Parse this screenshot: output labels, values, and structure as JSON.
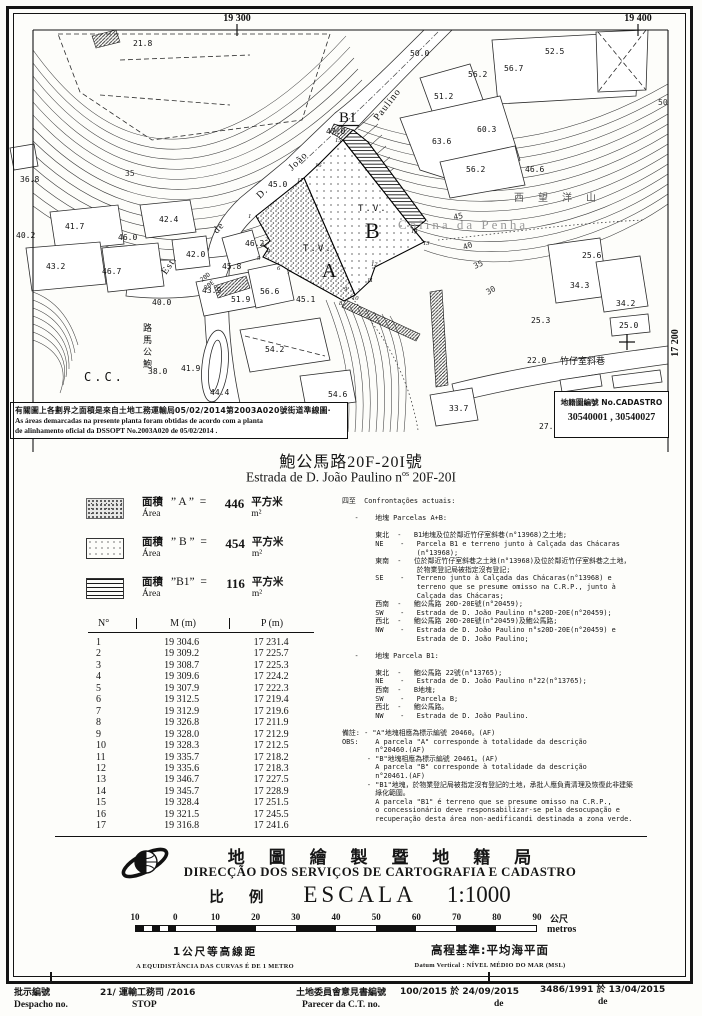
{
  "map": {
    "grid_labels": {
      "top_left": "19 300",
      "top_right": "19 400",
      "right": "17 200"
    },
    "labels": [
      {
        "t": "19 300",
        "x": 237,
        "y": 21,
        "s": 10,
        "c": "coord"
      },
      {
        "t": "19 400",
        "x": 638,
        "y": 21,
        "s": 10,
        "c": "coord"
      },
      {
        "t": "17 200",
        "x": 678,
        "y": 343,
        "s": 10,
        "r": -90,
        "c": "coord"
      },
      {
        "t": "21.8",
        "x": 133,
        "y": 46
      },
      {
        "t": "36.8",
        "x": 20,
        "y": 182
      },
      {
        "t": "35",
        "x": 125,
        "y": 176,
        "c": "contour"
      },
      {
        "t": "40.2",
        "x": 16,
        "y": 238
      },
      {
        "t": "41.7",
        "x": 65,
        "y": 229
      },
      {
        "t": "46.0",
        "x": 118,
        "y": 240
      },
      {
        "t": "43.2",
        "x": 46,
        "y": 269
      },
      {
        "t": "46.7",
        "x": 102,
        "y": 274
      },
      {
        "t": "42.4",
        "x": 159,
        "y": 222
      },
      {
        "t": "42.0",
        "x": 186,
        "y": 257
      },
      {
        "t": "40.0",
        "x": 152,
        "y": 305
      },
      {
        "t": "38.0",
        "x": 148,
        "y": 374
      },
      {
        "t": "41.9",
        "x": 181,
        "y": 371
      },
      {
        "t": "44.4",
        "x": 210,
        "y": 395
      },
      {
        "t": "C.C.",
        "x": 84,
        "y": 381,
        "s": 12,
        "c": "cc"
      },
      {
        "t": "54.2",
        "x": 265,
        "y": 352
      },
      {
        "t": "54.6",
        "x": 328,
        "y": 397
      },
      {
        "t": "45.1",
        "x": 296,
        "y": 302
      },
      {
        "t": "56.6",
        "x": 260,
        "y": 294
      },
      {
        "t": "51.9",
        "x": 231,
        "y": 302
      },
      {
        "t": "43.9",
        "x": 202,
        "y": 293
      },
      {
        "t": "45.8",
        "x": 222,
        "y": 269
      },
      {
        "t": "46.2",
        "x": 245,
        "y": 246
      },
      {
        "t": "20D",
        "x": 202,
        "y": 282,
        "s": 6,
        "r": -38
      },
      {
        "t": "20E",
        "x": 206,
        "y": 290,
        "s": 6,
        "r": -38
      },
      {
        "t": "45.0",
        "x": 268,
        "y": 187
      },
      {
        "t": "47.0",
        "x": 326,
        "y": 134
      },
      {
        "t": "50.0",
        "x": 410,
        "y": 56
      },
      {
        "t": "51.2",
        "x": 434,
        "y": 99
      },
      {
        "t": "56.2",
        "x": 468,
        "y": 77
      },
      {
        "t": "56.7",
        "x": 504,
        "y": 71
      },
      {
        "t": "52.5",
        "x": 545,
        "y": 54
      },
      {
        "t": "63.6",
        "x": 432,
        "y": 144
      },
      {
        "t": "60.3",
        "x": 477,
        "y": 132
      },
      {
        "t": "56.2",
        "x": 466,
        "y": 172
      },
      {
        "t": "46.6",
        "x": 525,
        "y": 172
      },
      {
        "t": "50",
        "x": 658,
        "y": 105,
        "c": "contour"
      },
      {
        "t": "25.6",
        "x": 582,
        "y": 258
      },
      {
        "t": "34.3",
        "x": 570,
        "y": 288
      },
      {
        "t": "34.2",
        "x": 616,
        "y": 306
      },
      {
        "t": "25.3",
        "x": 531,
        "y": 323
      },
      {
        "t": "25.0",
        "x": 619,
        "y": 328
      },
      {
        "t": "22.0",
        "x": 527,
        "y": 363
      },
      {
        "t": "竹仔室斜巷",
        "x": 560,
        "y": 364,
        "s": 9,
        "c": "zh"
      },
      {
        "t": "33.7",
        "x": 449,
        "y": 411
      },
      {
        "t": "27.",
        "x": 539,
        "y": 429
      },
      {
        "t": "45",
        "x": 454,
        "y": 220,
        "r": -12,
        "c": "contour"
      },
      {
        "t": "40",
        "x": 464,
        "y": 250,
        "r": -20,
        "c": "contour"
      },
      {
        "t": "35",
        "x": 475,
        "y": 269,
        "r": -25,
        "c": "contour"
      },
      {
        "t": "30",
        "x": 488,
        "y": 295,
        "r": -30,
        "c": "contour"
      },
      {
        "t": "西望洋山",
        "x": 562,
        "y": 201,
        "s": 10,
        "c": "zhg"
      },
      {
        "t": "Colina da Penha",
        "x": 398,
        "y": 229,
        "s": 13,
        "c": "gray"
      },
      {
        "t": "Est.",
        "x": 166,
        "y": 275,
        "s": 10,
        "r": -55,
        "c": "street"
      },
      {
        "t": "de",
        "x": 217,
        "y": 234,
        "s": 10,
        "r": -48,
        "c": "street"
      },
      {
        "t": "D.",
        "x": 260,
        "y": 199,
        "s": 10,
        "r": -44,
        "c": "street"
      },
      {
        "t": "João",
        "x": 292,
        "y": 171,
        "s": 10,
        "r": -44,
        "c": "street"
      },
      {
        "t": "Paulino",
        "x": 378,
        "y": 121,
        "s": 10,
        "r": -52,
        "c": "street"
      },
      {
        "t": "路",
        "x": 143,
        "y": 331,
        "s": 9,
        "c": "zh"
      },
      {
        "t": "馬",
        "x": 143,
        "y": 343,
        "s": 9,
        "c": "zh"
      },
      {
        "t": "公",
        "x": 143,
        "y": 355,
        "s": 9,
        "c": "zh"
      },
      {
        "t": "鮑",
        "x": 143,
        "y": 367,
        "s": 9,
        "c": "zh"
      },
      {
        "t": "T.V.",
        "x": 303,
        "y": 251,
        "s": 9,
        "c": "tv"
      },
      {
        "t": "A",
        "x": 322,
        "y": 277,
        "s": 20,
        "c": "parcel"
      },
      {
        "t": "T.V.",
        "x": 358,
        "y": 211,
        "s": 9,
        "c": "tv"
      },
      {
        "t": "B",
        "x": 365,
        "y": 238,
        "s": 22,
        "c": "parcel"
      },
      {
        "t": "B1",
        "x": 339,
        "y": 122,
        "s": 15,
        "c": "parcel"
      },
      {
        "t": "1",
        "x": 248,
        "y": 218,
        "c": "vx"
      },
      {
        "t": "2",
        "x": 265,
        "y": 241,
        "c": "vx"
      },
      {
        "t": "3",
        "x": 261,
        "y": 247,
        "c": "vx"
      },
      {
        "t": "4",
        "x": 267,
        "y": 253,
        "c": "vx"
      },
      {
        "t": "5",
        "x": 257,
        "y": 260,
        "c": "vx"
      },
      {
        "t": "6",
        "x": 277,
        "y": 270,
        "c": "vx"
      },
      {
        "t": "7",
        "x": 287,
        "y": 274,
        "c": "vx"
      },
      {
        "t": "8",
        "x": 339,
        "y": 305,
        "c": "vx"
      },
      {
        "t": "9",
        "x": 344,
        "y": 291,
        "c": "vx"
      },
      {
        "t": "10",
        "x": 352,
        "y": 300,
        "c": "vx"
      },
      {
        "t": "11",
        "x": 367,
        "y": 282,
        "c": "vx"
      },
      {
        "t": "12",
        "x": 371,
        "y": 266,
        "c": "vx"
      },
      {
        "t": "13",
        "x": 423,
        "y": 245,
        "c": "vx"
      },
      {
        "t": "14",
        "x": 411,
        "y": 233,
        "c": "vx"
      },
      {
        "t": "15",
        "x": 335,
        "y": 142,
        "c": "vx"
      },
      {
        "t": "16",
        "x": 315,
        "y": 167,
        "c": "vx"
      },
      {
        "t": "17",
        "x": 297,
        "y": 182,
        "c": "vx"
      }
    ],
    "note_box": {
      "line_zh": "有關圖上各劃界之面積是來自土地工務運輸局05/02/2014第2003A020號街道準線圖·",
      "line_pt1": "As áreas demarcadas na presente planta foram obtidas de acordo com a planta",
      "line_pt2": "de alinhamento oficial da DSSOPT  No.2003A020 de 05/02/2014 ."
    },
    "cadastro_box": {
      "title": "地籍圖編號 No.CADASTRO",
      "numbers": "30540001 , 30540027"
    }
  },
  "title": {
    "zh": "鮑公馬路20F-20I號",
    "pt_prefix": "Estrada de D. João Paulino n",
    "pt_sup": "os",
    "pt_suffix": " 20F-20I"
  },
  "legend": {
    "items": [
      {
        "zh": "面積",
        "pt": "Área",
        "q": "” A ”  =",
        "value": "446",
        "unit_zh": "平方米",
        "unit_pt": "m²",
        "pattern": "stipple"
      },
      {
        "zh": "面積",
        "pt": "Área",
        "q": "” B ”  =",
        "value": "454",
        "unit_zh": "平方米",
        "unit_pt": "m²",
        "pattern": "dots"
      },
      {
        "zh": "面積",
        "pt": "Área",
        "q": "”B1”  =",
        "value": "116",
        "unit_zh": "平方米",
        "unit_pt": "m²",
        "pattern": "hlines"
      }
    ]
  },
  "coords_table": {
    "headers": [
      "N°",
      "M (m)",
      "P (m)"
    ],
    "rows": [
      [
        "1",
        "19 304.6",
        "17 231.4"
      ],
      [
        "2",
        "19 309.2",
        "17 225.7"
      ],
      [
        "3",
        "19 308.7",
        "17 225.3"
      ],
      [
        "4",
        "19 309.6",
        "17 224.2"
      ],
      [
        "5",
        "19 307.9",
        "17 222.3"
      ],
      [
        "6",
        "19 312.5",
        "17 219.4"
      ],
      [
        "7",
        "19 312.9",
        "17 219.6"
      ],
      [
        "8",
        "19 326.8",
        "17 211.9"
      ],
      [
        "9",
        "19 328.0",
        "17 212.9"
      ],
      [
        "10",
        "19 328.3",
        "17 212.5"
      ],
      [
        "11",
        "19 335.7",
        "17 218.2"
      ],
      [
        "12",
        "19 335.6",
        "17 218.3"
      ],
      [
        "13",
        "19 346.7",
        "17 227.5"
      ],
      [
        "14",
        "19 345.7",
        "17 228.9"
      ],
      [
        "15",
        "19 328.4",
        "17 251.5"
      ],
      [
        "16",
        "19 321.5",
        "17 245.5"
      ],
      [
        "17",
        "19 316.8",
        "17 241.6"
      ]
    ]
  },
  "right_block": {
    "lines": [
      "四至  Confrontações actuais:",
      "",
      "   -    地塊 Parcelas A+B:",
      "",
      "        東北  -   B1地塊及位於鄰近竹仔室斜巷(n°13968)之土地;",
      "        NE    -   Parcela B1 e terreno junto à Calçada das Chácaras",
      "                  (n°13968);",
      "        東南  -   位於鄰近竹仔室斜巷之土地(n°13968)及位於鄰近竹仔室斜巷之土地，",
      "                  於物業登記局被指定沒有登記;",
      "        SE    -   Terreno junto à Calçada das Chácaras(n°13968) e",
      "                  terreno que se presume omisso na C.R.P., junto à",
      "                  Calçada das Chácaras;",
      "        西南  -   鮑公馬路 20D-20E號(n°20459);",
      "        SW    -   Estrada de D. João Paulino n°s20D-20E(n°20459);",
      "        西北  -   鮑公馬路 20D-20E號(n°20459)及鮑公馬路;",
      "        NW    -   Estrada de D. João Paulino n°s20D-20E(n°20459) e",
      "                  Estrada de D. João Paulino;",
      "",
      "   -    地塊 Parcela B1:",
      "",
      "        東北  -   鮑公馬路 22號(n°13765);",
      "        NE    -   Estrada de D. João Paulino n°22(n°13765);",
      "        西南  -   B地塊;",
      "        SW    -   Parcela B;",
      "        西北  -   鮑公馬路。",
      "        NW    -   Estrada de D. João Paulino.",
      "",
      "備註: - \"A\"地塊相應為標示編號 20460。(AF)",
      "OBS:    A parcela \"A\" corresponde à totalidade da descrição",
      "        n°20460.(AF)",
      "      - \"B\"地塊相應為標示編號 20461。(AF)",
      "        A parcela \"B\" corresponde à totalidade da descrição",
      "        n°20461.(AF)",
      "      - \"B1\"地塊，於物業登記局被指定沒有登記的土地，承批人應負責清理及恢復此非建築",
      "        綠化範圍。",
      "        A parcela \"B1\" é terreno que se presume omisso na C.R.P.,",
      "        o concessionário deve responsabilizar-se pela desocupação e",
      "        recuperação desta área non-aedificandi destinada a zona verde."
    ]
  },
  "agency": {
    "zh": "地 圖 繪 製 暨 地 籍 局",
    "pt": "DIRECÇÃO DOS SERVIÇOS DE CARTOGRAFIA E CADASTRO"
  },
  "scale": {
    "zh": "比 例",
    "label": "ESCALA",
    "ratio": "1:1000"
  },
  "scalebar": {
    "ticks": [
      "10",
      "0",
      "10",
      "20",
      "30",
      "40",
      "50",
      "60",
      "70",
      "80",
      "90"
    ],
    "unit_zh": "公尺",
    "unit_pt": "metros"
  },
  "equidistance": {
    "zh": "1公尺等高線距",
    "pt": "A EQUIDISTÂNCIA DAS CURVAS É DE 1 METRO"
  },
  "datum": {
    "zh": "高程基準:平均海平面",
    "pt": "Datum Vertical : NÍVEL MÉDIO DO MAR (MSL)"
  },
  "footer": {
    "despacho_zh": "批示編號",
    "despacho_pt": "Despacho no.",
    "despacho_value": "21/ 運輸工務司 /2016",
    "despacho_value2": "STOP",
    "parecer_zh": "土地委員會意見書編號",
    "parecer_pt": "Parecer da C.T. no.",
    "parecer_value": "100/2015 於 24/09/2015",
    "parecer_de": "de",
    "ref_value": "3486/1991 於 13/04/2015",
    "ref_de": "de"
  }
}
